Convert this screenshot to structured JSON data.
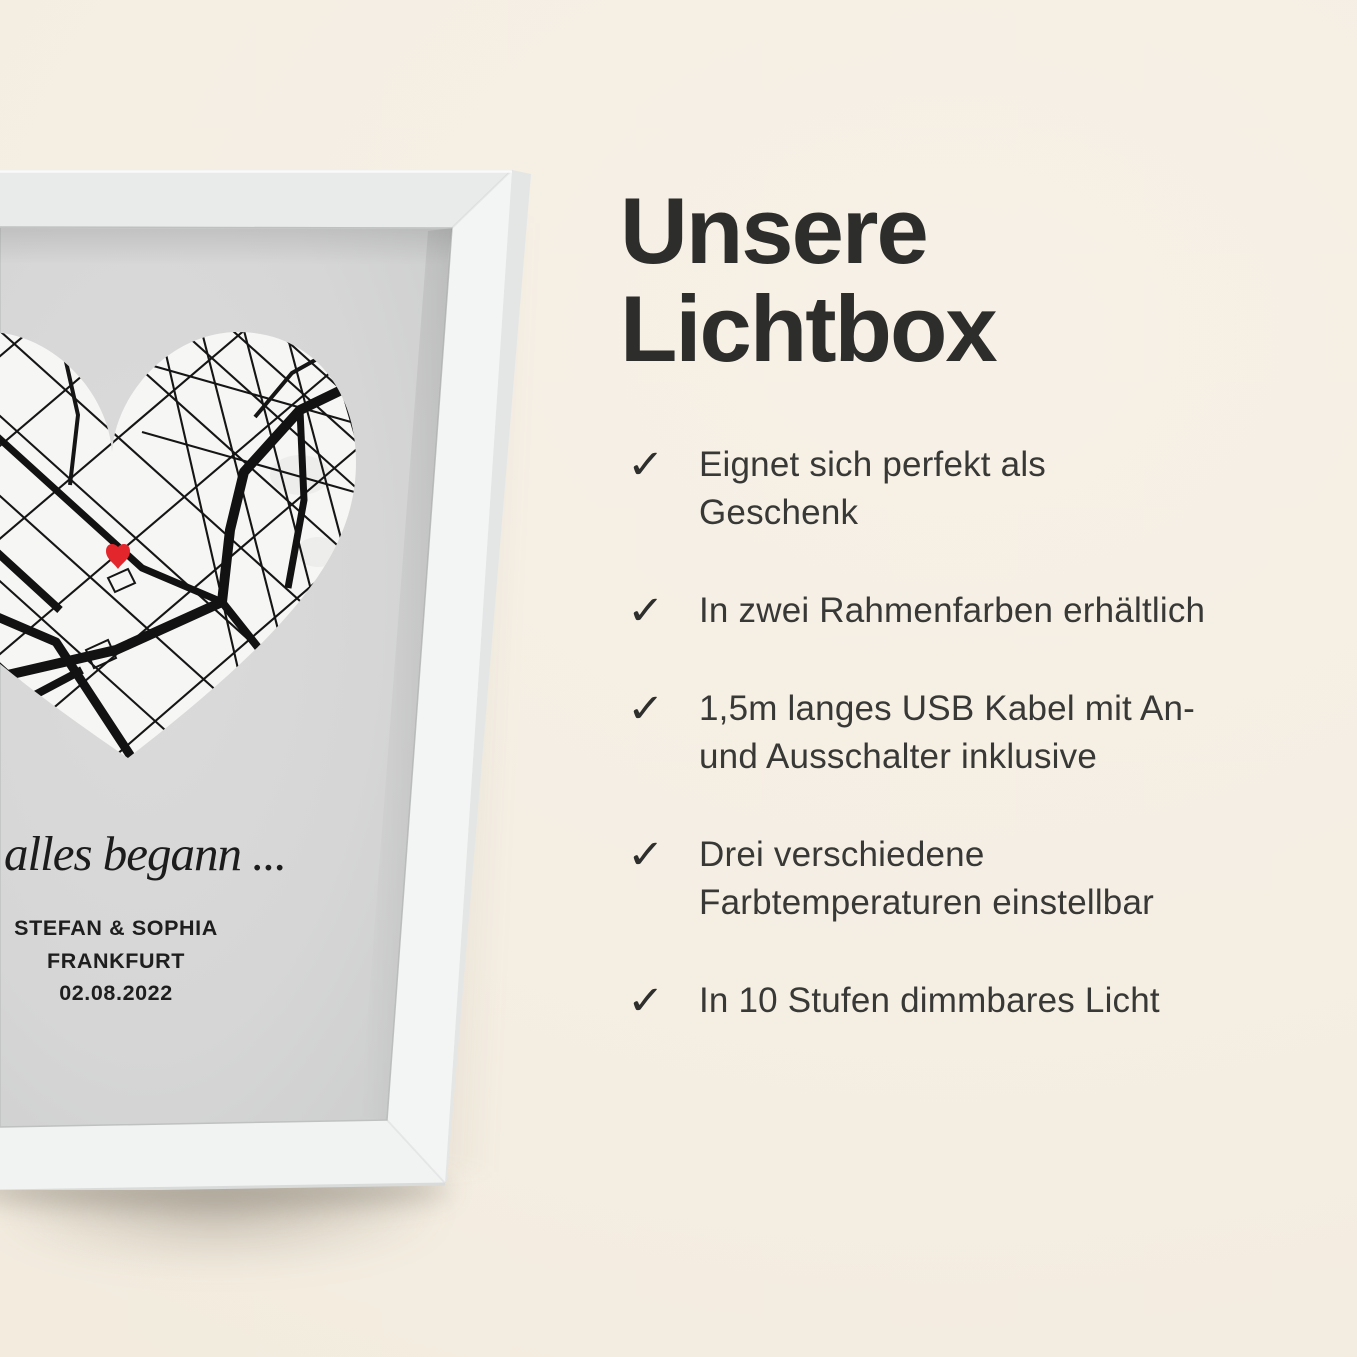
{
  "colors": {
    "background_cream": "#f5eee3",
    "frame_white": "#f2f3f3",
    "print_gray": "#d8d8d8",
    "heart_map_white": "#f6f6f5",
    "street_black": "#151515",
    "marker_red": "#e3252c",
    "title_text": "#2d2d2b",
    "body_text": "#383836"
  },
  "product": {
    "type_label": "white-framed-lightbox-heart-map",
    "script_caption": "alles begann ...",
    "names": "STEFAN & SOPHIA",
    "city": "FRANKFURT",
    "date": "02.08.2022",
    "marker_color": "#e3252c"
  },
  "panel": {
    "title": "Unsere Lichtbox",
    "check": "✓",
    "features": [
      {
        "lines": [
          "Eignet sich perfekt als",
          "Geschenk"
        ]
      },
      {
        "lines": [
          "In zwei Rahmenfarben erhältlich"
        ]
      },
      {
        "lines": [
          "1,5m langes USB Kabel mit An-",
          "und Ausschalter inklusive"
        ]
      },
      {
        "lines": [
          "Drei verschiedene",
          "Farbtemperaturen einstellbar"
        ]
      },
      {
        "lines": [
          "In 10 Stufen dimmbares Licht"
        ]
      }
    ]
  }
}
